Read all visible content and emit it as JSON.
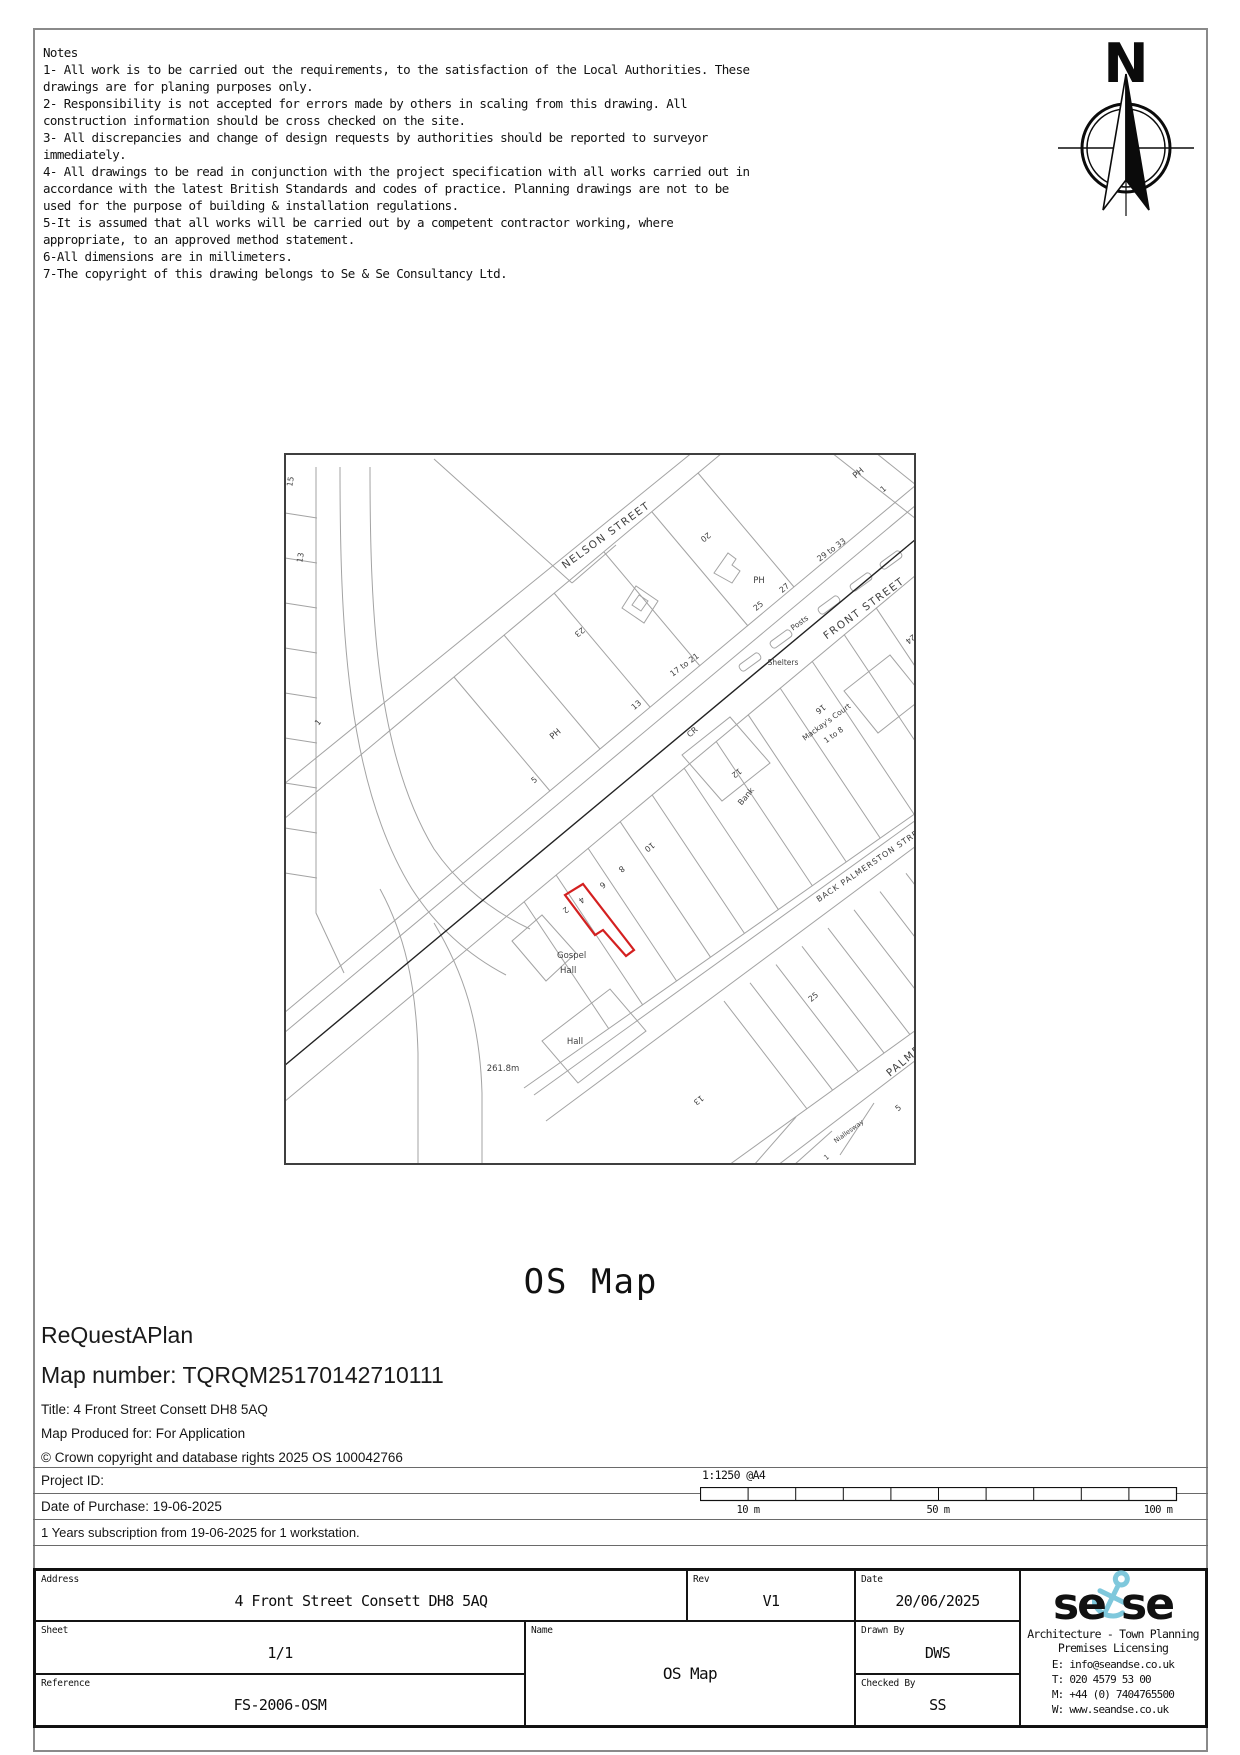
{
  "notes": {
    "title": "Notes",
    "lines": [
      "1- All work is to be carried out the requirements, to the satisfaction of the Local Authorities. These",
      "drawings are for planing purposes only.",
      "2- Responsibility is not accepted for errors made by others in scaling from this drawing. All",
      "construction information should be cross checked on the site.",
      "3- All discrepancies and change of design requests by authorities should be reported to surveyor",
      "immediately.",
      "4- All drawings to be read in conjunction with the project specification with all works carried out in",
      "accordance with the latest British Standards and codes of practice. Planning drawings are not to be",
      "used for the purpose of building & installation regulations.",
      "5-It is assumed that all works will be carried out by a competent contractor working, where",
      "appropriate, to an approved method statement.",
      "6-All dimensions are in millimeters.",
      "7-The copyright of this drawing belongs to Se & Se Consultancy Ltd."
    ]
  },
  "north_arrow": {
    "label": "N"
  },
  "map": {
    "line_color": "#a3a3a3",
    "boundary_color": "#222222",
    "site_color": "#d42020",
    "site_outline": "299,431 281,442 311,482 319,477 342,503 350,497",
    "labels": [
      {
        "t": "15",
        "x": 9,
        "y": 29,
        "r": -80,
        "s": 8
      },
      {
        "t": "13",
        "x": 19,
        "y": 105,
        "r": -80,
        "s": 8
      },
      {
        "t": "1",
        "x": 36,
        "y": 271,
        "r": -50,
        "s": 8
      },
      {
        "t": "NELSON STREET",
        "x": 324,
        "y": 85,
        "r": -36,
        "s": 10.5,
        "sp": 1.5
      },
      {
        "t": "23",
        "x": 294,
        "y": 177,
        "r": 142,
        "s": 8
      },
      {
        "t": "20",
        "x": 420,
        "y": 82,
        "r": 142,
        "s": 8
      },
      {
        "t": "PH",
        "x": 576,
        "y": 22,
        "r": -40,
        "s": 8.5
      },
      {
        "t": "1",
        "x": 601,
        "y": 38,
        "r": -40,
        "s": 8
      },
      {
        "t": "29 to 33",
        "x": 549,
        "y": 99,
        "r": -36,
        "s": 8
      },
      {
        "t": "FRONT STREET",
        "x": 582,
        "y": 158,
        "r": -36,
        "s": 10.5,
        "sp": 1.5
      },
      {
        "t": "24",
        "x": 625,
        "y": 184,
        "r": 142,
        "s": 8
      },
      {
        "t": "PH",
        "x": 475,
        "y": 130,
        "r": 0,
        "s": 8.5
      },
      {
        "t": "27",
        "x": 502,
        "y": 137,
        "r": -40,
        "s": 8
      },
      {
        "t": "25",
        "x": 476,
        "y": 155,
        "r": -40,
        "s": 8
      },
      {
        "t": "Posts",
        "x": 517,
        "y": 172,
        "r": -36,
        "s": 7.5
      },
      {
        "t": "17 to 21",
        "x": 402,
        "y": 214,
        "r": -36,
        "s": 8
      },
      {
        "t": "Shelters",
        "x": 499,
        "y": 212,
        "r": 0,
        "s": 7.5
      },
      {
        "t": "13",
        "x": 354,
        "y": 254,
        "r": -40,
        "s": 8
      },
      {
        "t": "PH",
        "x": 273,
        "y": 283,
        "r": -40,
        "s": 8.5
      },
      {
        "t": "5",
        "x": 252,
        "y": 329,
        "r": -40,
        "s": 8
      },
      {
        "t": "CR",
        "x": 410,
        "y": 281,
        "r": -40,
        "s": 8
      },
      {
        "t": "16",
        "x": 535,
        "y": 254,
        "r": 142,
        "s": 8
      },
      {
        "t": "Mackay's Court",
        "x": 544,
        "y": 271,
        "r": -36,
        "s": 7.5
      },
      {
        "t": "1 to 8",
        "x": 551,
        "y": 284,
        "r": -36,
        "s": 7.5
      },
      {
        "t": "12",
        "x": 451,
        "y": 318,
        "r": 142,
        "s": 8
      },
      {
        "t": "Bank",
        "x": 464,
        "y": 345,
        "r": -50,
        "s": 8
      },
      {
        "t": "10",
        "x": 364,
        "y": 392,
        "r": 142,
        "s": 8
      },
      {
        "t": "8",
        "x": 336,
        "y": 414,
        "r": 142,
        "s": 8
      },
      {
        "t": "6",
        "x": 317,
        "y": 430,
        "r": 142,
        "s": 8
      },
      {
        "t": "4",
        "x": 296,
        "y": 445,
        "r": 142,
        "s": 8
      },
      {
        "t": "2",
        "x": 280,
        "y": 455,
        "r": 142,
        "s": 8
      },
      {
        "t": "Gospel",
        "x": 273,
        "y": 505,
        "r": 0,
        "s": 8.5,
        "a": "start"
      },
      {
        "t": "Hall",
        "x": 276,
        "y": 520,
        "r": 0,
        "s": 8.5,
        "a": "start"
      },
      {
        "t": "Hall",
        "x": 291,
        "y": 591,
        "r": 0,
        "s": 8.5
      },
      {
        "t": "261.8m",
        "x": 219,
        "y": 618,
        "r": 0,
        "s": 8.5
      },
      {
        "t": "BACK PALMERSTON STREET",
        "x": 590,
        "y": 412,
        "r": -34,
        "s": 8,
        "sp": 1
      },
      {
        "t": "25",
        "x": 531,
        "y": 546,
        "r": -40,
        "s": 8
      },
      {
        "t": "PALMERSTON STREET",
        "x": 606,
        "y": 624,
        "r": -40,
        "s": 10.5,
        "sp": 1.5,
        "a": "start"
      },
      {
        "t": "13",
        "x": 413,
        "y": 645,
        "r": 142,
        "s": 8
      },
      {
        "t": "Niallesway",
        "x": 566,
        "y": 680,
        "r": -36,
        "s": 6.5
      },
      {
        "t": "5",
        "x": 616,
        "y": 657,
        "r": -40,
        "s": 8
      },
      {
        "t": "1",
        "x": 544,
        "y": 706,
        "r": -40,
        "s": 7
      }
    ]
  },
  "heading": {
    "title": "OS Map"
  },
  "info": {
    "brand": "ReQuestAPlan",
    "map_number": "Map number: TQRQM25170142710111",
    "title_line": "Title: 4 Front Street Consett DH8 5AQ",
    "produced_line": "Map Produced for: For Application",
    "copyright_line": "© Crown copyright and database rights 2025 OS 100042766",
    "project_line": "Project ID:",
    "purchase_line": "Date of Purchase: 19-06-2025",
    "subscription_line": "1 Years subscription from 19-06-2025 for 1 workstation."
  },
  "scalebar": {
    "ratio": "1:1250 @A4",
    "segments": 10,
    "labels": [
      "10 m",
      "50 m",
      "100 m"
    ]
  },
  "titleblock": {
    "address_label": "Address",
    "address": "4 Front Street Consett DH8 5AQ",
    "rev_label": "Rev",
    "rev": "V1",
    "date_label": "Date",
    "date": "20/06/2025",
    "sheet_label": "Sheet",
    "sheet": "1/1",
    "name_label": "Name",
    "name": "OS Map",
    "drawn_label": "Drawn By",
    "drawn": "DWS",
    "checked_label": "Checked By",
    "checked": "SS",
    "reference_label": "Reference",
    "reference": "FS-2006-OSM",
    "logo": {
      "word1": "se",
      "word2": "se",
      "accent": "#7fc8dc",
      "tagline1": "Architecture - Town Planning",
      "tagline2": "Premises Licensing",
      "contact": [
        "E: info@seandse.co.uk",
        "T: 020 4579 53 00",
        "M: +44 (0) 7404765500",
        "W: www.seandse.co.uk"
      ]
    }
  }
}
